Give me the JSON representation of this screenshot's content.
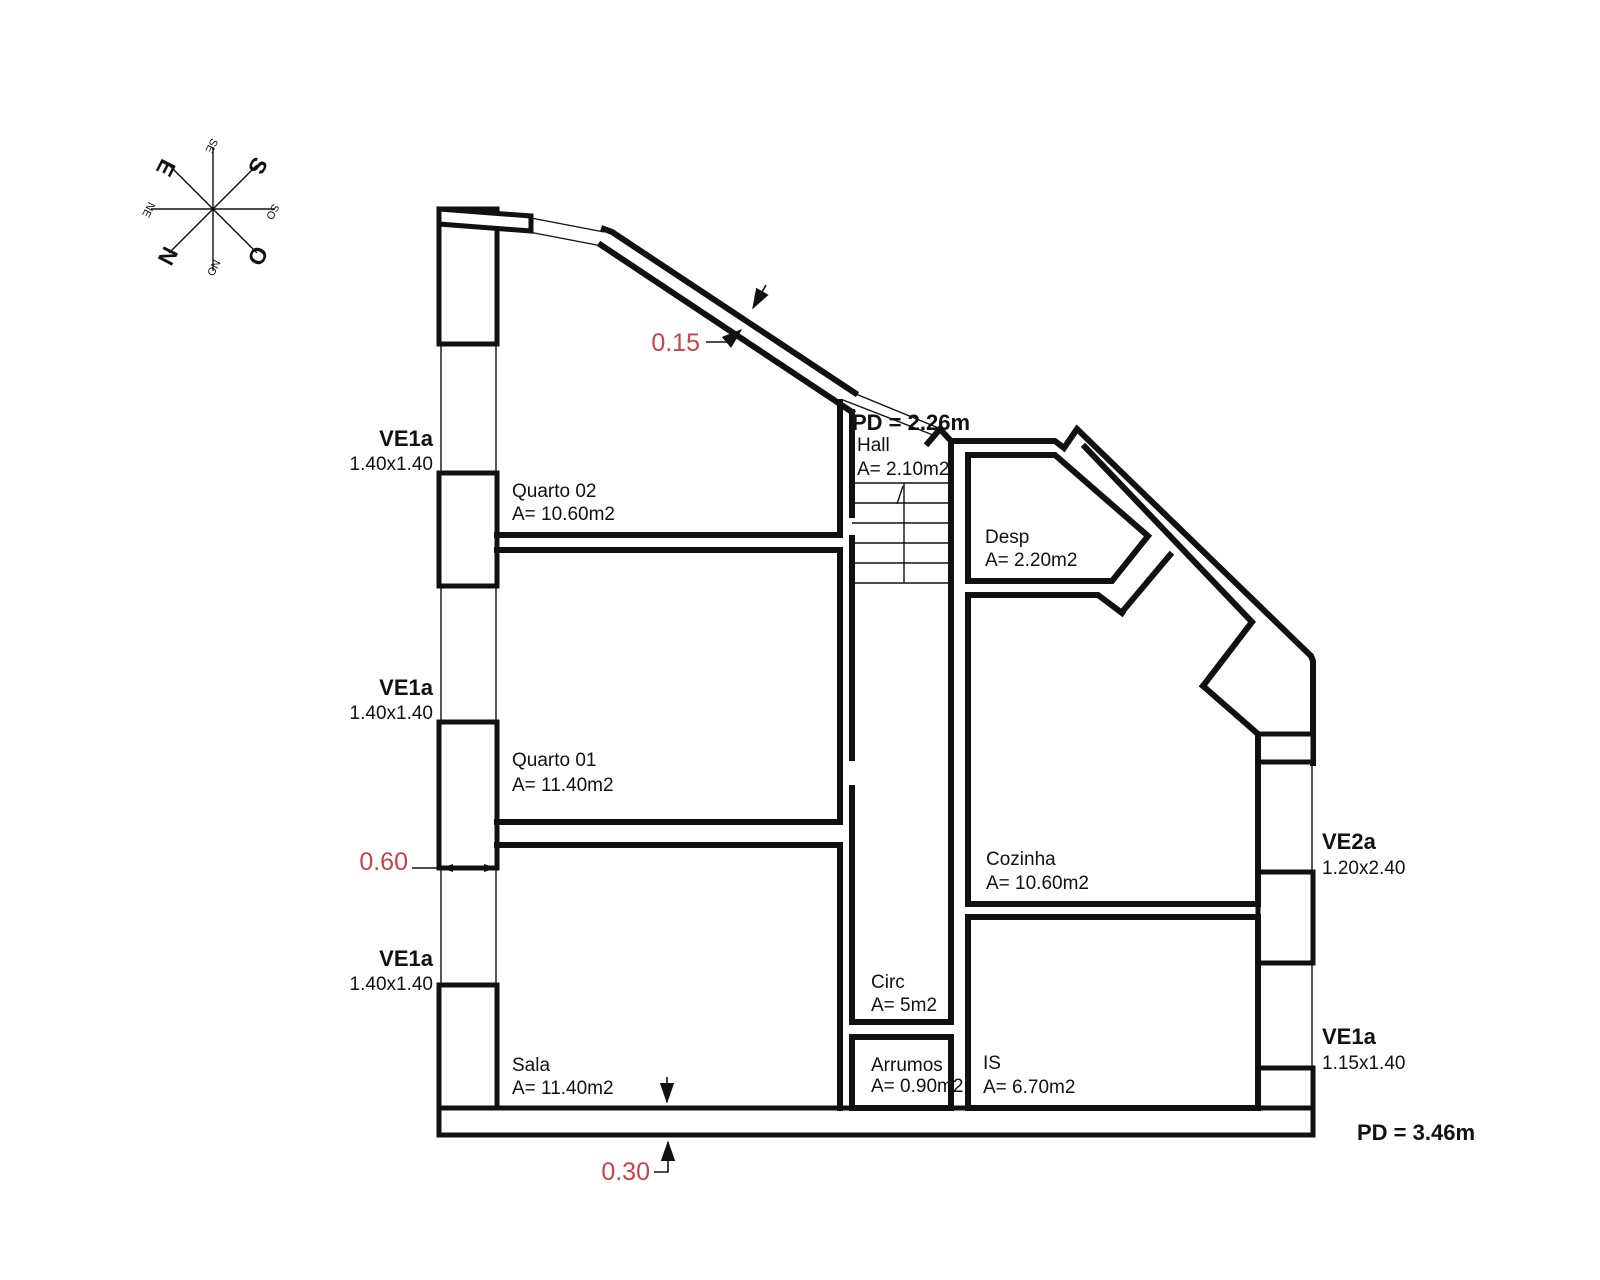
{
  "plan": {
    "rooms": {
      "quarto02": {
        "name": "Quarto 02",
        "area": "A= 10.60m2"
      },
      "quarto01": {
        "name": "Quarto 01",
        "area": "A= 11.40m2"
      },
      "sala": {
        "name": "Sala",
        "area": "A= 11.40m2"
      },
      "hall": {
        "name": "Hall",
        "area": "A= 2.10m2"
      },
      "circ": {
        "name": "Circ",
        "area": "A= 5m2"
      },
      "arrumos": {
        "name": "Arrumos",
        "area": "A= 0.90m2"
      },
      "is": {
        "name": "IS",
        "area": "A= 6.70m2"
      },
      "desp": {
        "name": "Desp",
        "area": "A= 2.20m2"
      },
      "cozinha": {
        "name": "Cozinha",
        "area": "A= 10.60m2"
      }
    },
    "windows": {
      "left1": {
        "code": "VE1a",
        "size": "1.40x1.40"
      },
      "left2": {
        "code": "VE1a",
        "size": "1.40x1.40"
      },
      "left3": {
        "code": "VE1a",
        "size": "1.40x1.40"
      },
      "right1": {
        "code": "VE2a",
        "size": "1.20x2.40"
      },
      "right2": {
        "code": "VE1a",
        "size": "1.15x1.40"
      }
    },
    "ceiling_heights": {
      "hall": "PD = 2.26m",
      "main": "PD = 3.46m"
    },
    "dimensions": {
      "wall_diagonal": "0.15",
      "wall_left": "0.60",
      "wall_bottom": "0.30"
    },
    "compass": {
      "n": "N",
      "s": "S",
      "e": "E",
      "o": "O",
      "ne": "NE",
      "se": "SE",
      "so": "SO",
      "no": "NO"
    },
    "colors": {
      "line": "#111111",
      "dimension_red": "#cc4149"
    }
  }
}
